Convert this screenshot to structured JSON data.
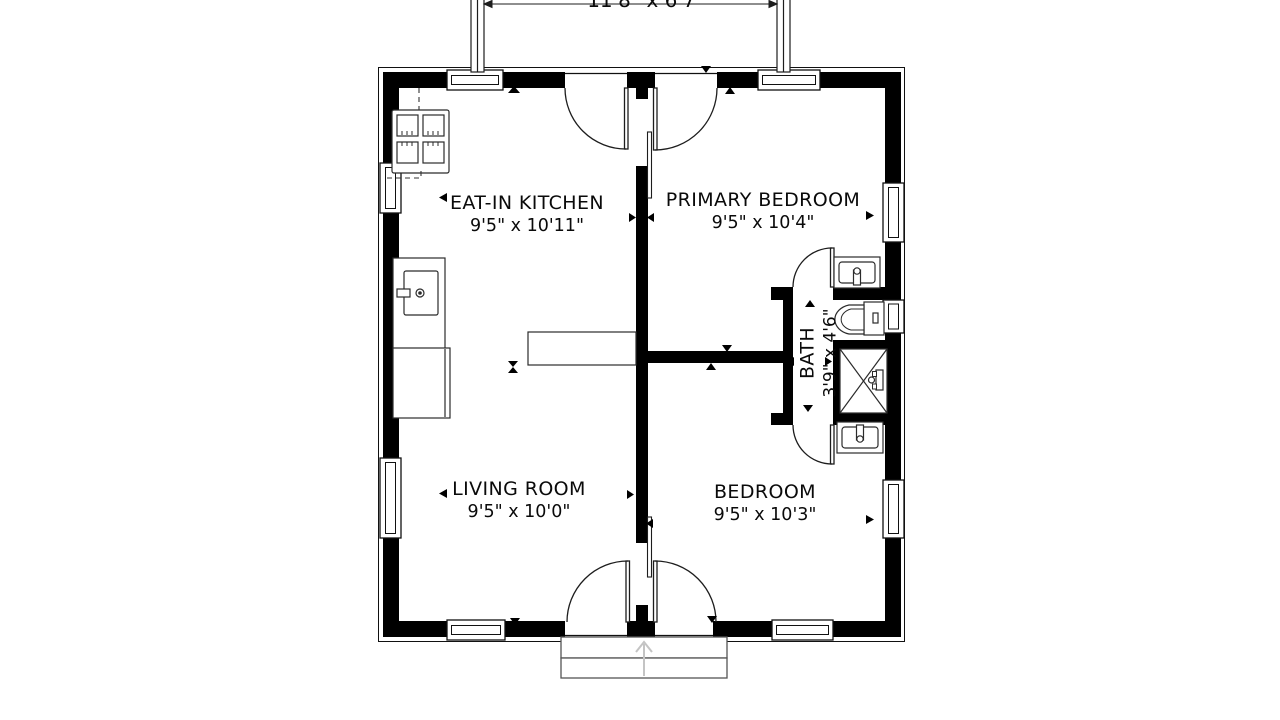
{
  "plan": {
    "type": "floor-plan",
    "deck": {
      "dims": "11'8\" x 6'7\""
    },
    "rooms": [
      {
        "name": "EAT-IN KITCHEN",
        "dims": "9'5\" x 10'11\""
      },
      {
        "name": "PRIMARY BEDROOM",
        "dims": "9'5\" x 10'4\""
      },
      {
        "name": "LIVING ROOM",
        "dims": "9'5\" x 10'0\""
      },
      {
        "name": "BEDROOM",
        "dims": "9'5\" x 10'3\""
      },
      {
        "name": "BATH",
        "dims": "3'9\" x 4'6\""
      }
    ],
    "fixtures": [
      "stove-icon",
      "kitchen-sink-icon",
      "refrigerator-icon",
      "kitchen-peninsula",
      "toilet-icon",
      "shower-icon",
      "vanity-sink-primary-icon",
      "vanity-sink-bedroom-icon",
      "entry-steps",
      "deck-posts",
      "entry-arrow-icon"
    ],
    "colors": {
      "wall": "#000000",
      "line": "#1a1a1a",
      "fixture_line": "#2b2b2b",
      "step_line": "#555555",
      "entry_arrow": "#c4c4c4",
      "background": "#ffffff"
    }
  }
}
